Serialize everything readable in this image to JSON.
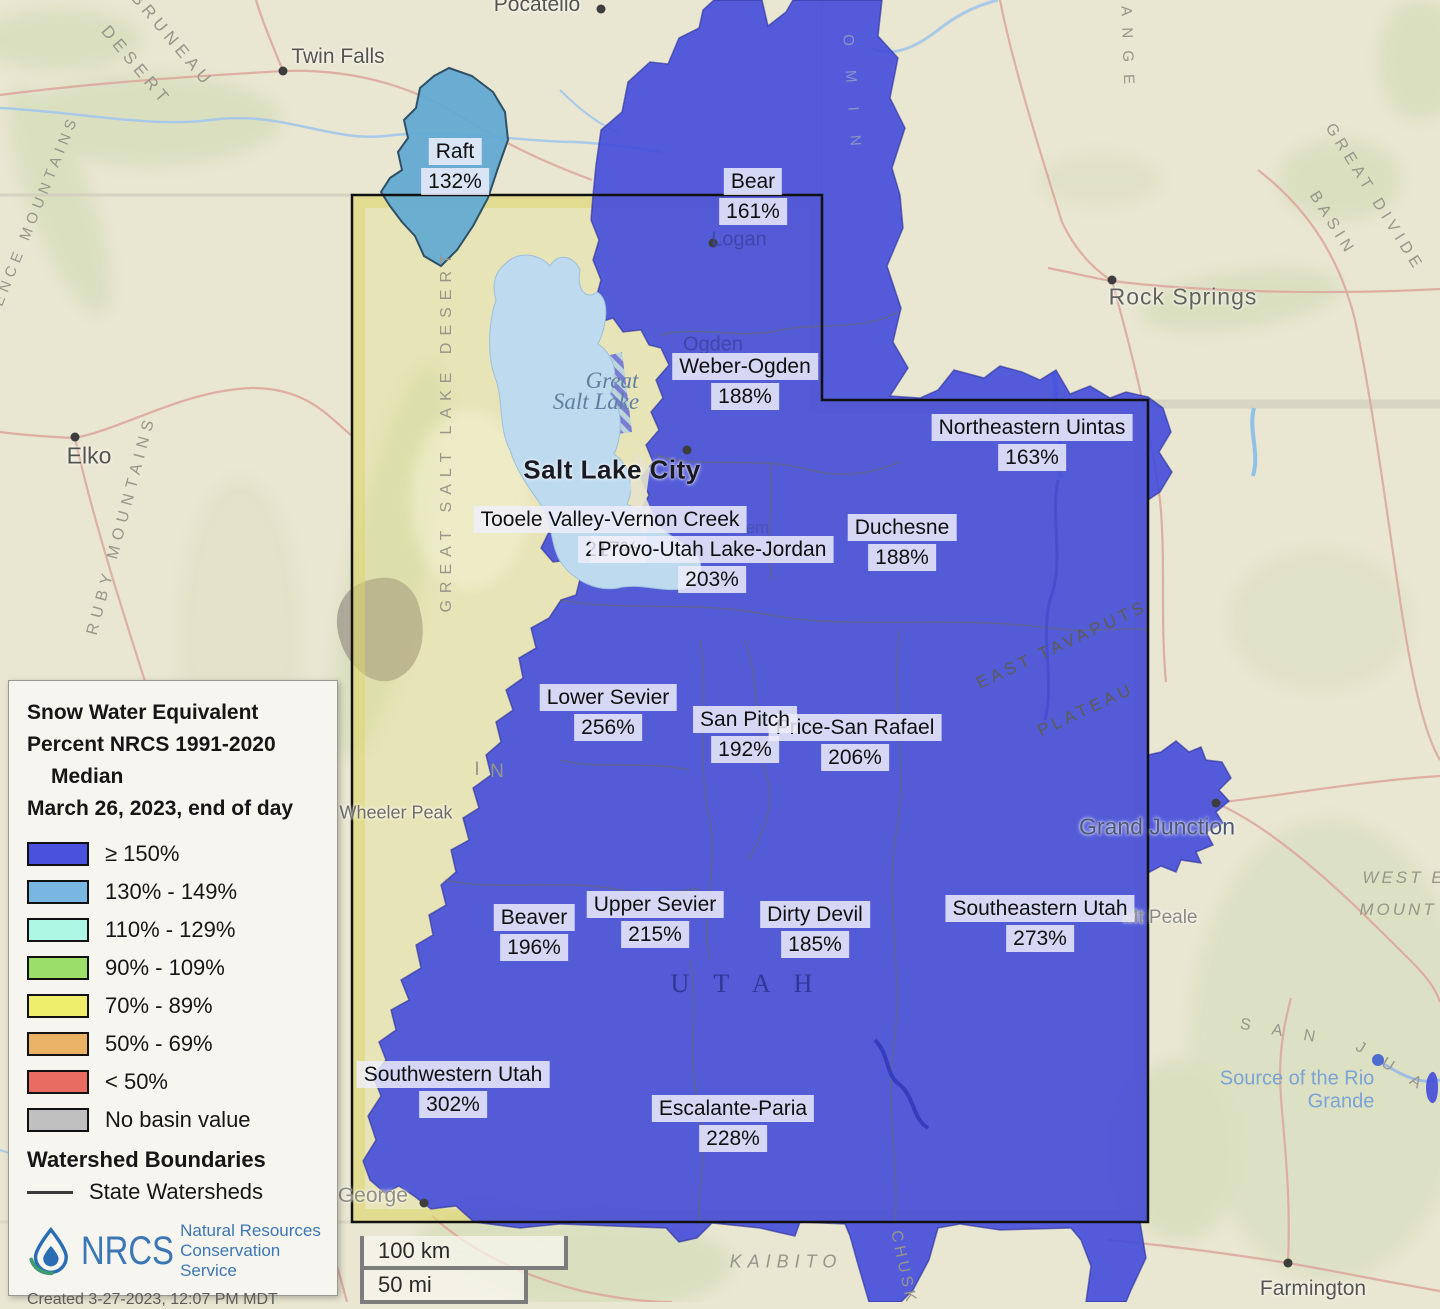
{
  "legend": {
    "title_line1": "Snow Water Equivalent",
    "title_line2": "Percent NRCS 1991-2020",
    "title_line3": "Median",
    "date_line": "March 26, 2023, end of day",
    "items": [
      {
        "label": "≥ 150%",
        "color": "#4a52dd"
      },
      {
        "label": "130% - 149%",
        "color": "#79b6e0"
      },
      {
        "label": "110% - 129%",
        "color": "#adf6e3"
      },
      {
        "label": "90% - 109%",
        "color": "#9bdf68"
      },
      {
        "label": "70% - 89%",
        "color": "#efed6c"
      },
      {
        "label": "50% - 69%",
        "color": "#e9b264"
      },
      {
        "label": "< 50%",
        "color": "#e96c62"
      },
      {
        "label": "No basin value",
        "color": "#c0c0c0"
      }
    ],
    "boundaries_title": "Watershed Boundaries",
    "boundaries_item": "State Watersheds",
    "logo_text": "NRCS",
    "logo_sub1": "Natural Resources",
    "logo_sub2": "Conservation Service",
    "created": "Created 3-27-2023, 12:07 PM MDT"
  },
  "scalebar": {
    "km": "100 km",
    "mi": "50 mi"
  },
  "watersheds": [
    {
      "name": "Raft",
      "value": "132%",
      "x": 455,
      "y": 138
    },
    {
      "name": "Bear",
      "value": "161%",
      "x": 753,
      "y": 168
    },
    {
      "name": "Weber-Ogden",
      "value": "188%",
      "x": 745,
      "y": 353
    },
    {
      "name": "Northeastern Uintas",
      "value": "163%",
      "x": 1032,
      "y": 414
    },
    {
      "name": "Duchesne",
      "value": "188%",
      "x": 902,
      "y": 514
    },
    {
      "name": "Tooele Valley-Vernon Creek",
      "value": "217%",
      "x": 610,
      "y": 506,
      "pct_x": 612
    },
    {
      "name": "Provo-Utah Lake-Jordan",
      "value": "203%",
      "x": 712,
      "y": 536
    },
    {
      "name": "Lower Sevier",
      "value": "256%",
      "x": 608,
      "y": 684
    },
    {
      "name": "Price-San Rafael",
      "value": "206%",
      "x": 855,
      "y": 714
    },
    {
      "name": "San Pitch",
      "value": "192%",
      "x": 745,
      "y": 706
    },
    {
      "name": "Beaver",
      "value": "196%",
      "x": 534,
      "y": 904
    },
    {
      "name": "Upper Sevier",
      "value": "215%",
      "x": 655,
      "y": 891
    },
    {
      "name": "Dirty Devil",
      "value": "185%",
      "x": 815,
      "y": 901
    },
    {
      "name": "Southeastern Utah",
      "value": "273%",
      "x": 1040,
      "y": 895
    },
    {
      "name": "Southwestern Utah",
      "value": "302%",
      "x": 453,
      "y": 1061
    },
    {
      "name": "Escalante-Paria",
      "value": "228%",
      "x": 733,
      "y": 1095
    }
  ],
  "cities": [
    {
      "name": "Pocatello",
      "x": 537,
      "y": 5,
      "dot": [
        601,
        9
      ],
      "cls": "c-gray"
    },
    {
      "name": "Twin Falls",
      "x": 338,
      "y": 57,
      "dot": [
        283,
        71
      ],
      "cls": "c-gray"
    },
    {
      "name": "Logan",
      "x": 739,
      "y": 240,
      "dot": [
        713,
        243
      ],
      "cls": "c-blue"
    },
    {
      "name": "Ogden",
      "x": 713,
      "y": 345,
      "cls": "c-blue"
    },
    {
      "name": "Salt Lake City",
      "x": 612,
      "y": 470,
      "dot": [
        687,
        450
      ],
      "cls": "c-slc"
    },
    {
      "name": "Orem",
      "x": 748,
      "y": 528,
      "cls": "c-blue-sm"
    },
    {
      "name": "Rock Springs",
      "x": 1183,
      "y": 297,
      "dot": [
        1112,
        280
      ],
      "cls": "c-rock"
    },
    {
      "name": "Elko",
      "x": 89,
      "y": 456,
      "dot": [
        75,
        437
      ],
      "cls": "c-elko"
    },
    {
      "name": "Wheeler Peak",
      "x": 396,
      "y": 813,
      "cls": "c-peak"
    },
    {
      "name": "Grand Junction",
      "x": 1157,
      "y": 827,
      "dot": [
        1216,
        803
      ],
      "cls": "c-gj"
    },
    {
      "name": "Mt Peale",
      "x": 1160,
      "y": 918,
      "cls": "c-peale"
    },
    {
      "name": "Saint George",
      "x": 346,
      "y": 1196,
      "dot": [
        424,
        1203
      ],
      "cls": "c-stg"
    },
    {
      "name": "Farmington",
      "x": 1313,
      "y": 1289,
      "dot": [
        1288,
        1263
      ],
      "cls": "c-gray"
    }
  ],
  "terrain_labels": [
    {
      "text": "BRUNEAU",
      "x": 172,
      "y": 40,
      "rot": 50,
      "ls": 5,
      "size": 17
    },
    {
      "text": "DESERT",
      "x": 136,
      "y": 66,
      "rot": 50,
      "ls": 5,
      "size": 17
    },
    {
      "text": "INDEPENDENCE MOUNTAINS",
      "x": 14,
      "y": 265,
      "rot": -68,
      "ls": 5,
      "size": 15
    },
    {
      "text": "RUBY MOUNTAINS",
      "x": 122,
      "y": 525,
      "rot": -75,
      "ls": 6,
      "size": 16
    },
    {
      "text": "GREAT SALT LAKE DESERT",
      "x": 447,
      "y": 430,
      "rot": -90,
      "ls": 7,
      "size": 16
    },
    {
      "text": "GREAT DIVIDE",
      "x": 1374,
      "y": 198,
      "rot": 58,
      "ls": 5,
      "size": 16
    },
    {
      "text": "BASIN",
      "x": 1332,
      "y": 224,
      "rot": 58,
      "ls": 5,
      "size": 16
    },
    {
      "text": "EAST TAVAPUTS",
      "x": 1062,
      "y": 645,
      "rot": -25,
      "ls": 4,
      "size": 17,
      "color": "#5e5e50"
    },
    {
      "text": "PLATEAU",
      "x": 1086,
      "y": 710,
      "rot": -25,
      "ls": 4,
      "size": 17,
      "color": "#5e5e50"
    },
    {
      "text": "WEST E",
      "x": 1404,
      "y": 878,
      "rot": 0,
      "ls": 3,
      "size": 17,
      "italic": true
    },
    {
      "text": "MOUNT",
      "x": 1398,
      "y": 910,
      "rot": 0,
      "ls": 3,
      "size": 17,
      "italic": true
    },
    {
      "text": "S A N",
      "x": 1282,
      "y": 1032,
      "rot": 10,
      "ls": 9,
      "size": 16
    },
    {
      "text": "J U A",
      "x": 1392,
      "y": 1068,
      "rot": 32,
      "ls": 9,
      "size": 16
    },
    {
      "text": "KAIBITO",
      "x": 786,
      "y": 1262,
      "rot": 0,
      "ls": 6,
      "size": 18,
      "italic": true
    },
    {
      "text": "CHUSK",
      "x": 903,
      "y": 1268,
      "rot": 78,
      "ls": 4,
      "size": 16
    },
    {
      "text": "V A D A",
      "x": 66,
      "y": 1024,
      "rot": 0,
      "ls": 6,
      "size": 18
    },
    {
      "text": "A",
      "x": 205,
      "y": 764,
      "rot": 0,
      "ls": 0,
      "size": 19
    },
    {
      "text": "S",
      "x": 322,
      "y": 768,
      "rot": 0,
      "ls": 0,
      "size": 19
    },
    {
      "text": "I",
      "x": 477,
      "y": 770,
      "rot": 0,
      "ls": 0,
      "size": 19
    },
    {
      "text": "N",
      "x": 497,
      "y": 772,
      "rot": 0,
      "ls": 0,
      "size": 19
    },
    {
      "text": "R A N G E",
      "x": 1127,
      "y": 36,
      "rot": 88,
      "ls": 4,
      "size": 15
    },
    {
      "text": "O M I N",
      "x": 852,
      "y": 95,
      "rot": 86,
      "ls": 10,
      "size": 15,
      "color": "#8b93c9"
    },
    {
      "text": "U T A H",
      "x": 746,
      "y": 984,
      "rot": 0,
      "ls": 9,
      "size": 26,
      "color": "#2b3a97",
      "serif": true
    }
  ],
  "water_labels": [
    {
      "text": "Great",
      "x": 612,
      "y": 381,
      "cls": "lake"
    },
    {
      "text": "Salt Lake",
      "x": 596,
      "y": 402,
      "cls": "lake"
    },
    {
      "text": "Source of the Rio",
      "x": 1297,
      "y": 1079,
      "cls": "rio"
    },
    {
      "text": "Grande",
      "x": 1341,
      "y": 1102,
      "cls": "rio"
    }
  ],
  "colors": {
    "basin_ge150": "#434bda",
    "basin_130_149": "#5fa8d1",
    "lake": "#bedaef",
    "state_border": "#111111"
  }
}
